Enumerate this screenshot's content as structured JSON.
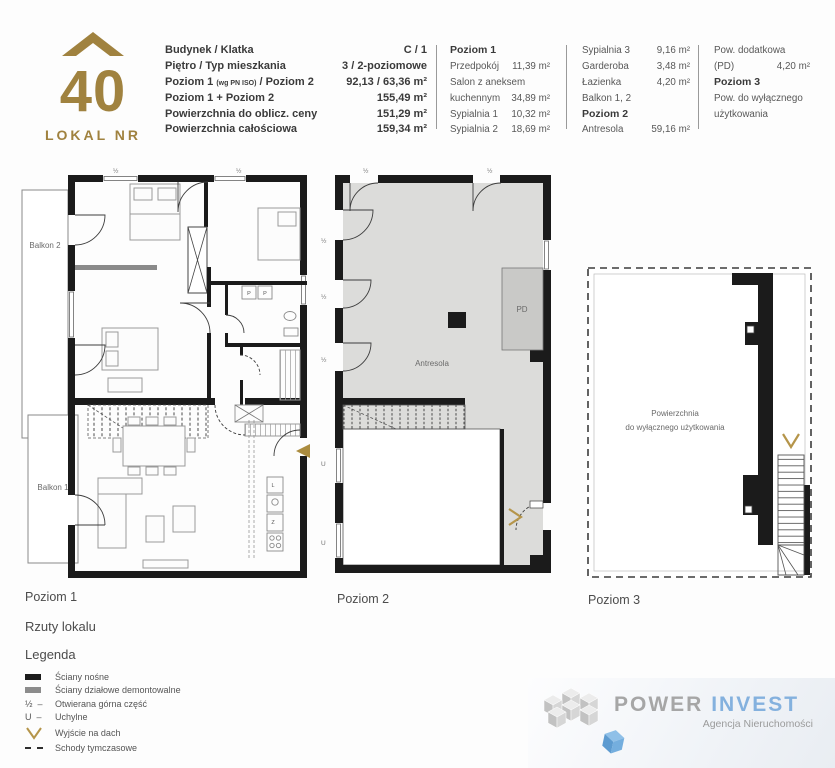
{
  "unit": {
    "number": "40",
    "caption": "LOKAL NR"
  },
  "info": {
    "col1": {
      "rows": [
        {
          "label": "Budynek / Klatka",
          "value": "C / 1"
        },
        {
          "label": "Piętro / Typ mieszkania",
          "value": "3 / 2-poziomowe"
        },
        {
          "label_pre": "Poziom 1 ",
          "label_small": "(wg PN ISO)",
          "label_post": " / Poziom 2",
          "value": "92,13 / 63,36 m²"
        },
        {
          "label": "Poziom 1 + Poziom 2",
          "value": "155,49 m²"
        },
        {
          "label": "Powierzchnia do oblicz. ceny",
          "value": "151,29 m²"
        },
        {
          "label": "Powierzchnia całościowa",
          "value": "159,34 m²"
        }
      ]
    },
    "col2": {
      "header": "Poziom 1",
      "rows": [
        {
          "label": "Przedpokój",
          "value": "11,39 m²"
        },
        {
          "label": "Salon z aneksem",
          "value": ""
        },
        {
          "label": "kuchennym",
          "value": "34,89 m²"
        },
        {
          "label": "Sypialnia 1",
          "value": "10,32 m²"
        },
        {
          "label": "Sypialnia 2",
          "value": "18,69 m²"
        }
      ]
    },
    "col3": {
      "rows1": [
        {
          "label": "Sypialnia 3",
          "value": "9,16 m²"
        },
        {
          "label": "Garderoba",
          "value": "3,48 m²"
        },
        {
          "label": "Łazienka",
          "value": "4,20 m²"
        },
        {
          "label": "Balkon 1, 2",
          "value": ""
        }
      ],
      "header": "Poziom 2",
      "rows2": [
        {
          "label": "Antresola",
          "value": "59,16 m²"
        }
      ]
    },
    "col4": {
      "row1_label": "Pow. dodatkowa",
      "row2_label": "(PD)",
      "row2_value": "4,20 m²",
      "header": "Poziom 3",
      "row3": "Pow. do wyłącznego",
      "row4": "użytkowania"
    }
  },
  "plans": {
    "p1": {
      "caption": "Poziom 1",
      "rooms": {
        "balkon2": "Balkon 2",
        "balkon1": "Balkon 1",
        "syp2": "Sypialnia 2",
        "syp3": "Sypialnia 3",
        "lazienka": "Łazienka",
        "syp1": "Sypialnia 1",
        "garderoba": "Garderoba",
        "przedpokoj": "Przedpokój",
        "salon": "Salon z aneksem"
      },
      "markers": {
        "half": "½",
        "u": "U",
        "p": "P",
        "l": "L",
        "z": "Z"
      }
    },
    "p2": {
      "caption": "Poziom 2",
      "rooms": {
        "antresola": "Antresola",
        "pd": "PD"
      },
      "markers": {
        "half": "½",
        "u": "U"
      }
    },
    "p3": {
      "caption": "Poziom 3",
      "label_line1": "Powierzchnia",
      "label_line2": "do wyłącznego użytkowania"
    }
  },
  "sections": {
    "plans_title": "Rzuty lokalu",
    "legend_title": "Legenda"
  },
  "legend": {
    "half_symbol": "½",
    "u_symbol": "U",
    "dash_symbol": "–",
    "items": [
      "Ściany nośne",
      "Ściany działowe demontowalne",
      "Otwierana górna część",
      "Uchylne",
      "Wyjście na dach",
      "Schody tymczasowe"
    ]
  },
  "footer": {
    "brand_power": "POWER",
    "brand_invest": "INVEST",
    "tagline": "Agencja Nieruchomości"
  },
  "colors": {
    "gold": "#a0823f",
    "wall": "#1b1b1b",
    "gray_wall": "#8a8a8a",
    "antresola_fill": "#dcdcda",
    "pd_fill": "#c9c9c7",
    "brand_gray": "#a6a6a6",
    "brand_blue": "#84b1de"
  }
}
